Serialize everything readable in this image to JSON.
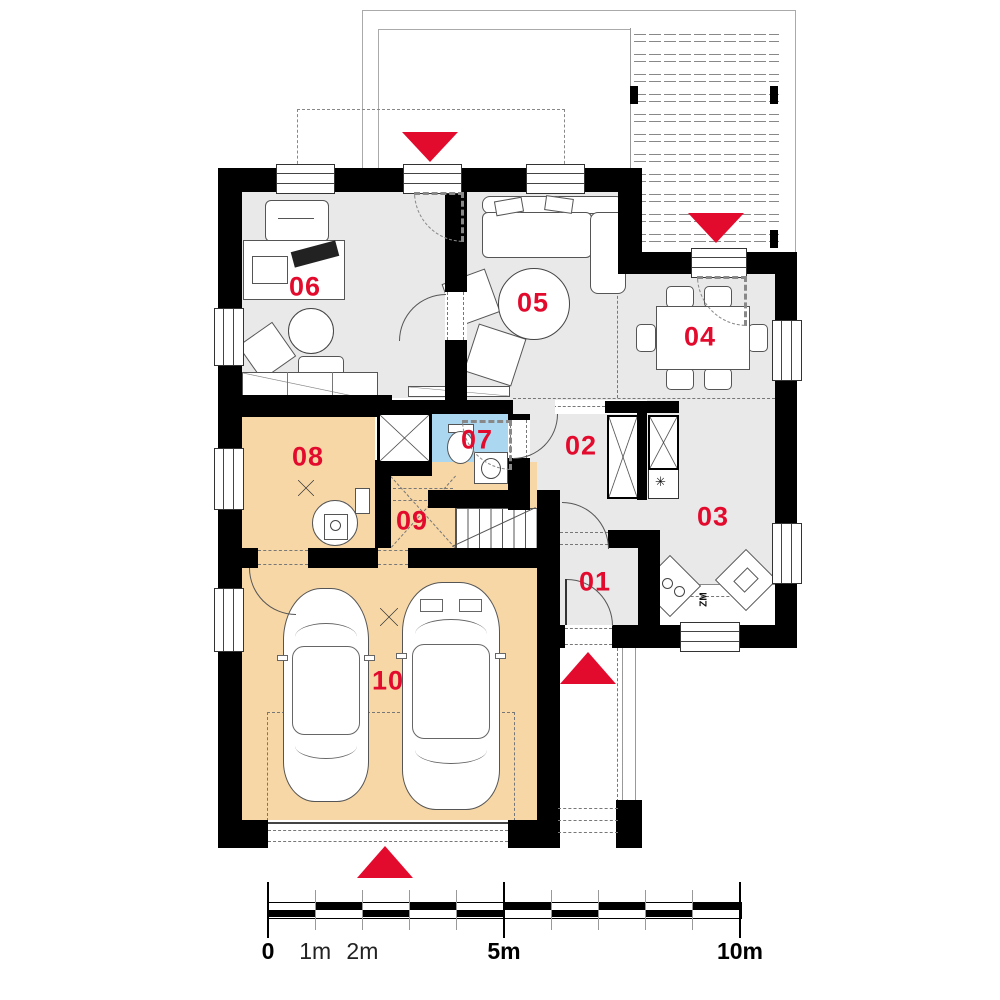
{
  "plan_type": "floor-plan",
  "rooms": {
    "r01": {
      "number": "01"
    },
    "r02": {
      "number": "02"
    },
    "r03": {
      "number": "03"
    },
    "r04": {
      "number": "04"
    },
    "r05": {
      "number": "05"
    },
    "r06": {
      "number": "06"
    },
    "r07": {
      "number": "07"
    },
    "r08": {
      "number": "08"
    },
    "r09": {
      "number": "09"
    },
    "r10": {
      "number": "10"
    }
  },
  "kitchen": {
    "dishwasher_label": "ZM",
    "freezer_symbol": "✳"
  },
  "scale_bar": {
    "meters": 10,
    "labels": [
      {
        "text": "0",
        "m": 0,
        "bold": true
      },
      {
        "text": "1m",
        "m": 1,
        "bold": false
      },
      {
        "text": "2m",
        "m": 2,
        "bold": false
      },
      {
        "text": "5m",
        "m": 5,
        "bold": true
      },
      {
        "text": "10m",
        "m": 10,
        "bold": true
      }
    ]
  },
  "colors": {
    "wall": "#000000",
    "floor_gray": "#e9e9e9",
    "floor_orange": "#f7d7a6",
    "floor_blue": "#abd7f1",
    "accent_red": "#e30b2d"
  },
  "icons": {
    "entrance_markers": "red-triangle-icon",
    "ventilation_shaft": "x-cross-shaft-icon",
    "wardrobe": "x-cross-wardrobe-icon",
    "ceiling_lamp": "x-lamp-icon"
  }
}
